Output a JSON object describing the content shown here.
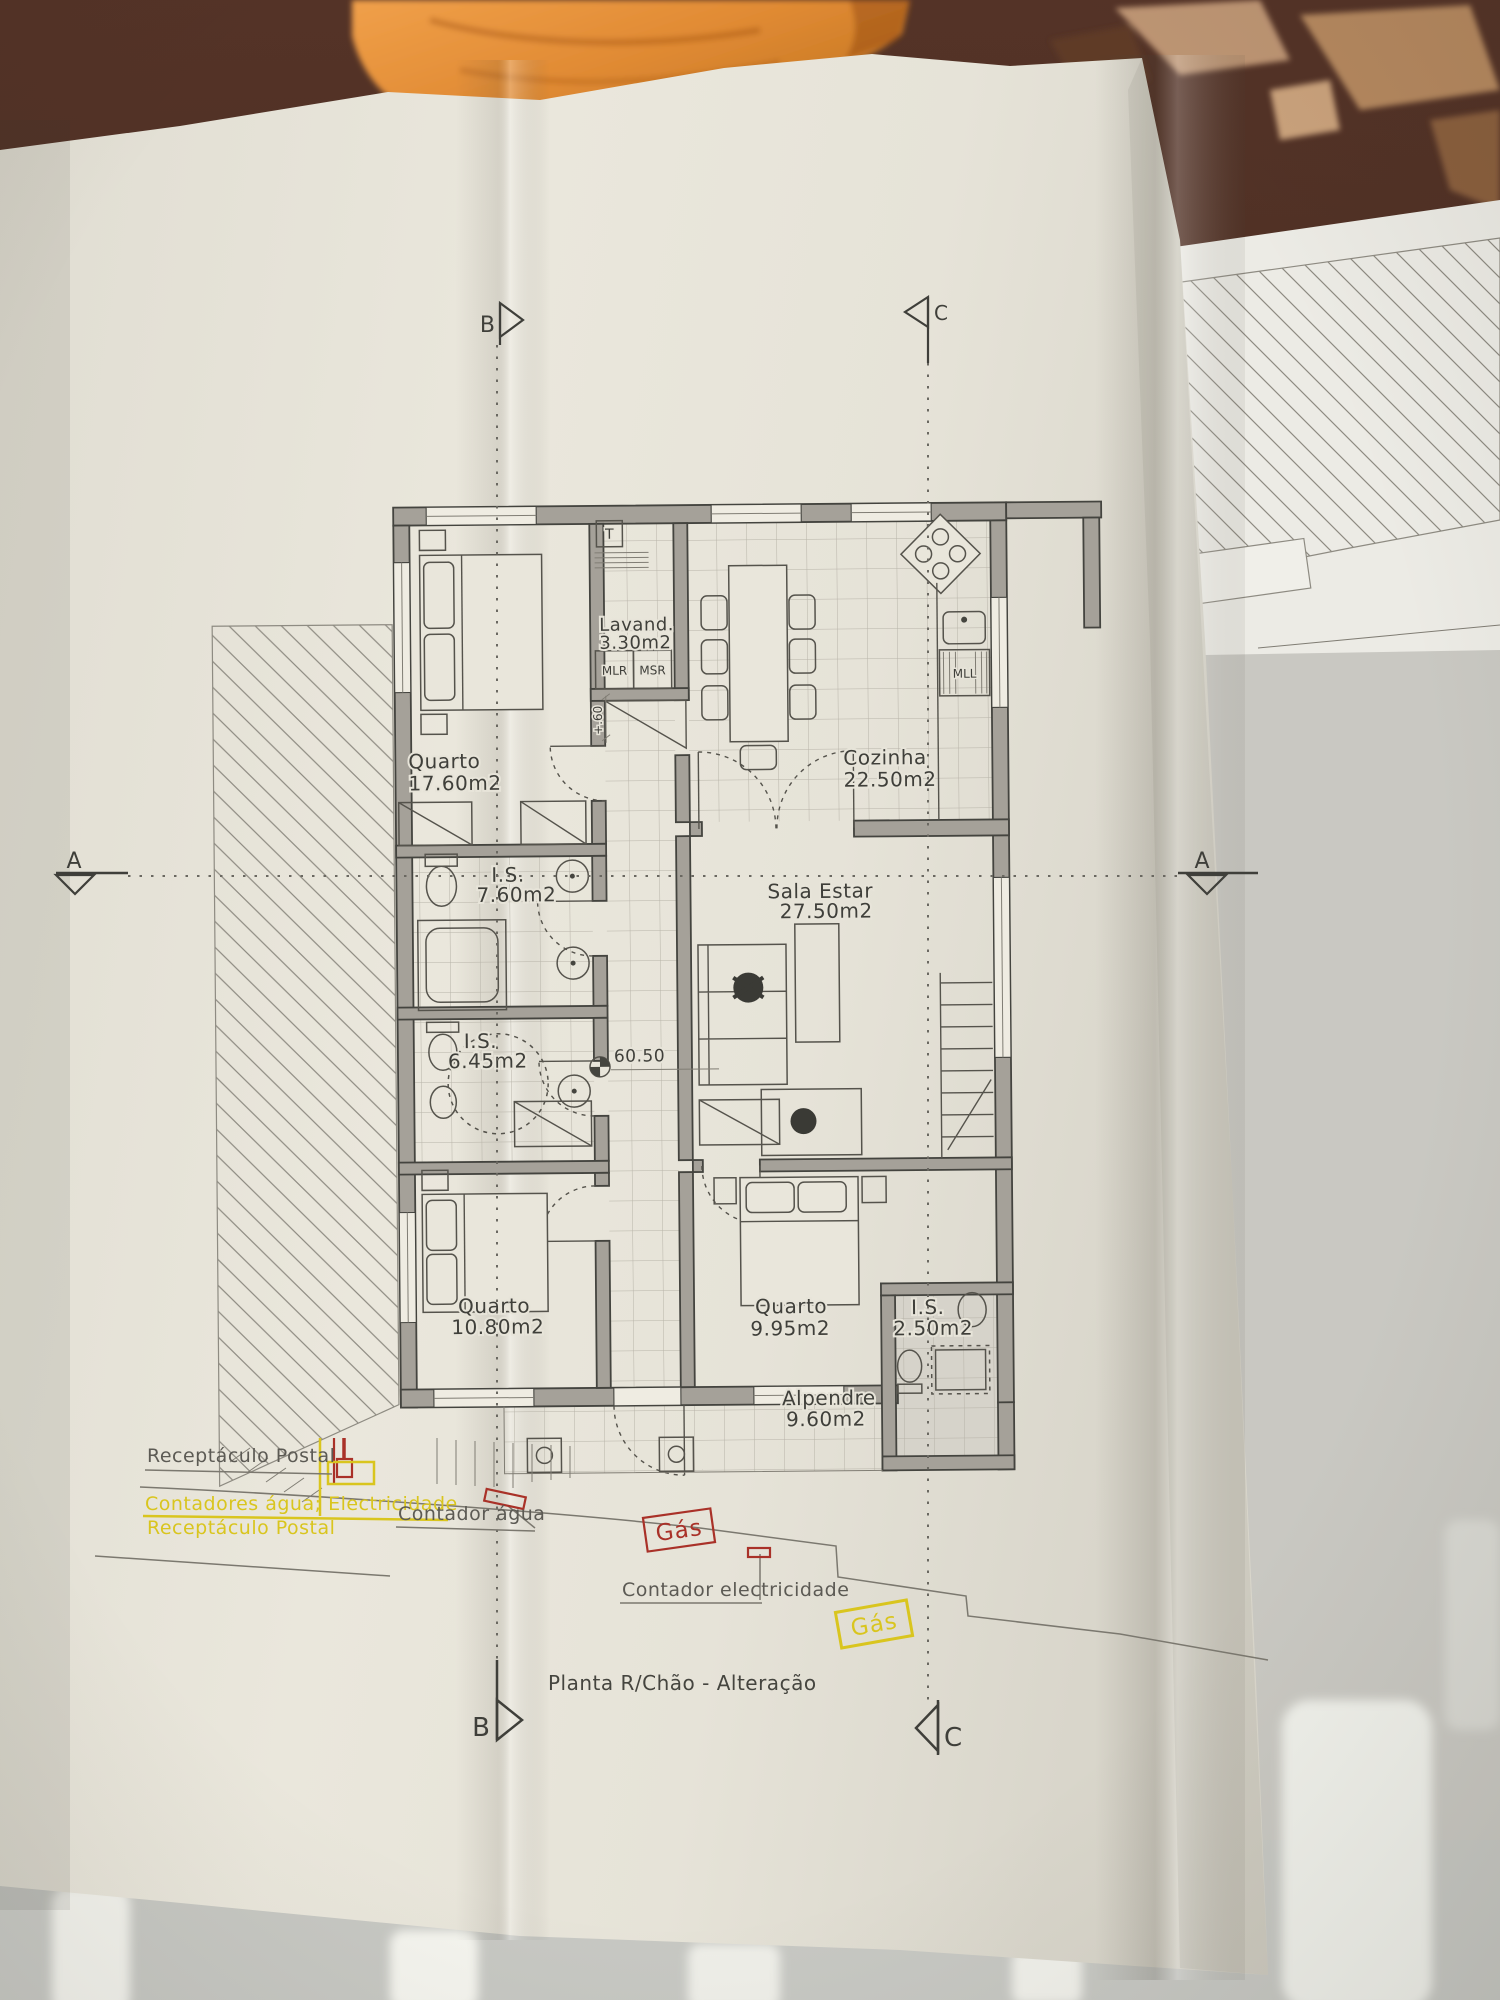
{
  "scene": {
    "background_color": "#47291c",
    "towel_color": "#e08a33",
    "paper_color": "#e6e3d8",
    "floor_color": "#c7c8c3"
  },
  "plan": {
    "title": "Planta R/Chão - Alteração",
    "rooms": [
      {
        "name": "Quarto",
        "area": "17.60m2"
      },
      {
        "name": "Lavand.",
        "area": "3.30m2"
      },
      {
        "name": "Cozinha",
        "area": "22.50m2"
      },
      {
        "name": "I.S.",
        "area": "7.60m2"
      },
      {
        "name": "Sala  Estar",
        "area": "27.50m2"
      },
      {
        "name": "I.S.",
        "area": "6.45m2"
      },
      {
        "name": "Quarto",
        "area": "10.80m2"
      },
      {
        "name": "Quarto",
        "area": "9.95m2"
      },
      {
        "name": "I.S.",
        "area": "2.50m2"
      },
      {
        "name": "Alpendre",
        "area": "9.60m2"
      }
    ],
    "labels": {
      "level": "60.50",
      "step_height": "+.60",
      "water_heater": "T",
      "washing_machine": "MLR",
      "drying_machine": "MSR",
      "dishwasher": "MLL"
    },
    "sections": {
      "a": "A",
      "b": "B",
      "c": "C"
    },
    "annotations": {
      "postal_existing": "Receptáculo Postal",
      "meters": "Contadores água; Electricidade",
      "postal_new": "Receptáculo Postal",
      "water_meter": "Contador água",
      "gas_upper": "Gás",
      "electricity_meter": "Contador electricidade",
      "gas_lower": "Gás"
    },
    "colors": {
      "ink": "#45453f",
      "wall_fill": "#a5a199",
      "highlight_yellow": "#d9c51e",
      "highlight_red": "#a93128"
    }
  }
}
